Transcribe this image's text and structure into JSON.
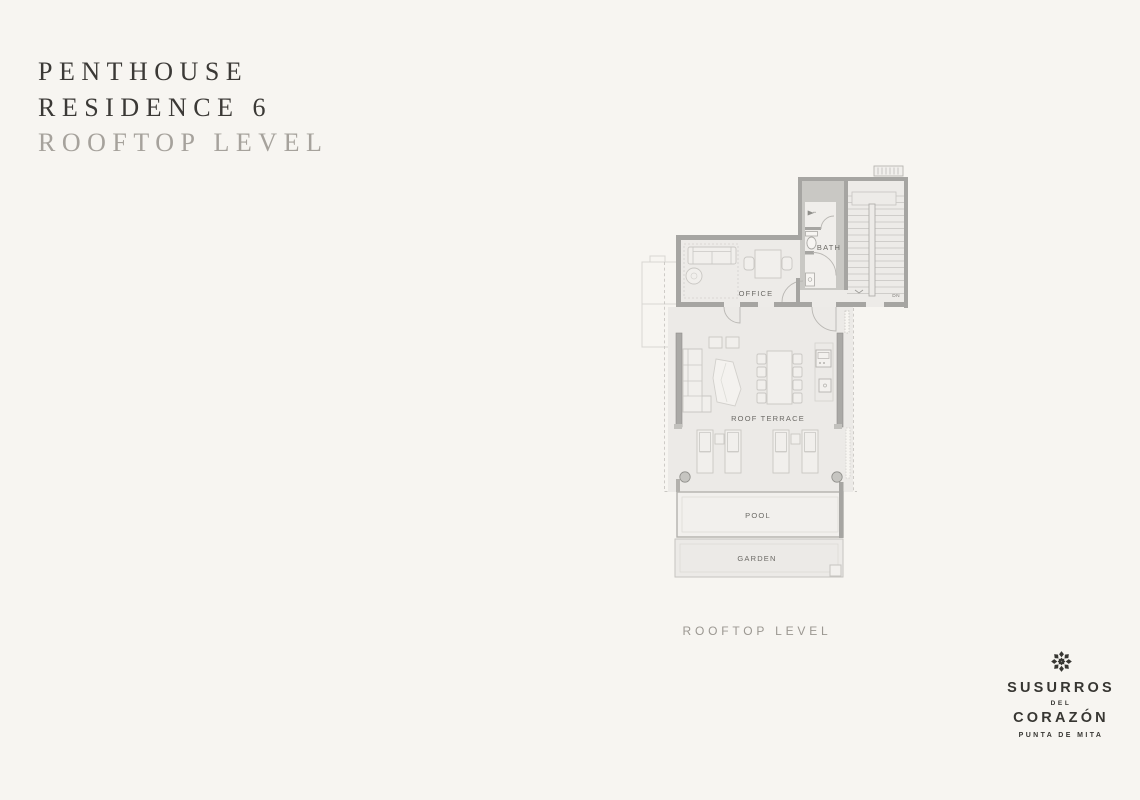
{
  "page": {
    "background": "#f7f5f1"
  },
  "title": {
    "line1": "PENTHOUSE",
    "line2": "RESIDENCE 6",
    "line3": "ROOFTOP LEVEL",
    "primary_color": "#3b3936",
    "secondary_color": "#a6a29c"
  },
  "plan": {
    "caption": "ROOFTOP LEVEL",
    "rooms": {
      "office": "OFFICE",
      "bath": "BATH",
      "terrace": "ROOF TERRACE",
      "pool": "POOL",
      "garden": "GARDEN"
    },
    "stairs": {
      "down_label": "DN"
    },
    "colors": {
      "room_fill": "#eceae7",
      "wall": "#a6a5a2",
      "poche": "#c9c8c4",
      "furniture_stroke": "#c9c7c3",
      "label": "#6b6965",
      "dashed_outline": "#c9c7c3"
    }
  },
  "brand": {
    "name_line1": "SUSURROS",
    "name_line2": "DEL",
    "name_line3": "CORAZÓN",
    "location": "PUNTA DE MITA",
    "icon": "rosette-icon",
    "color": "#373632"
  }
}
